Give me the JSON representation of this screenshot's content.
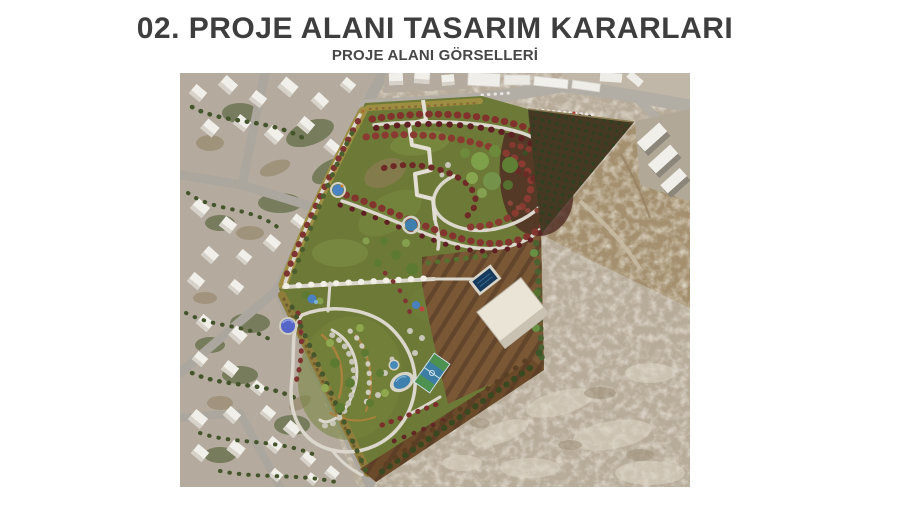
{
  "slide": {
    "title": "02. PROJE ALANI TASARIM KARARLARI",
    "subtitle": "PROJE ALANI GÖRSELLERİ"
  },
  "image": {
    "description": "Aerial drone photo with rendered park landscape design: residential neighborhood on the left, park with red tree alleys, winding white paths, stepped zigzag walkway, pergola path, playgrounds, pools, pavilion, basketball court, olive orchard triangle and barren rocky terrain at lower right",
    "features": [
      "residential-neighborhood",
      "park-lawn",
      "red-tree-alleys",
      "winding-paths",
      "zigzag-stepped-path",
      "pergola-path",
      "flower-border-strips",
      "silver-tree-loop",
      "playground-dome",
      "ponds",
      "swimming-pool",
      "pavilion",
      "basketball-court",
      "tilled-brown-field",
      "olive-orchard",
      "rocky-barren-terrain",
      "roads",
      "apartment-blocks",
      "parked-cars"
    ],
    "colors": {
      "title_text": "#3e3e3e",
      "park_green": "#6d7a37",
      "red_trees": "#81322c",
      "rocky_ground": "#b7ab99",
      "tilled_soil": "#7a5836",
      "water": "#2f6a94",
      "paths": "#dbd7cc"
    }
  }
}
